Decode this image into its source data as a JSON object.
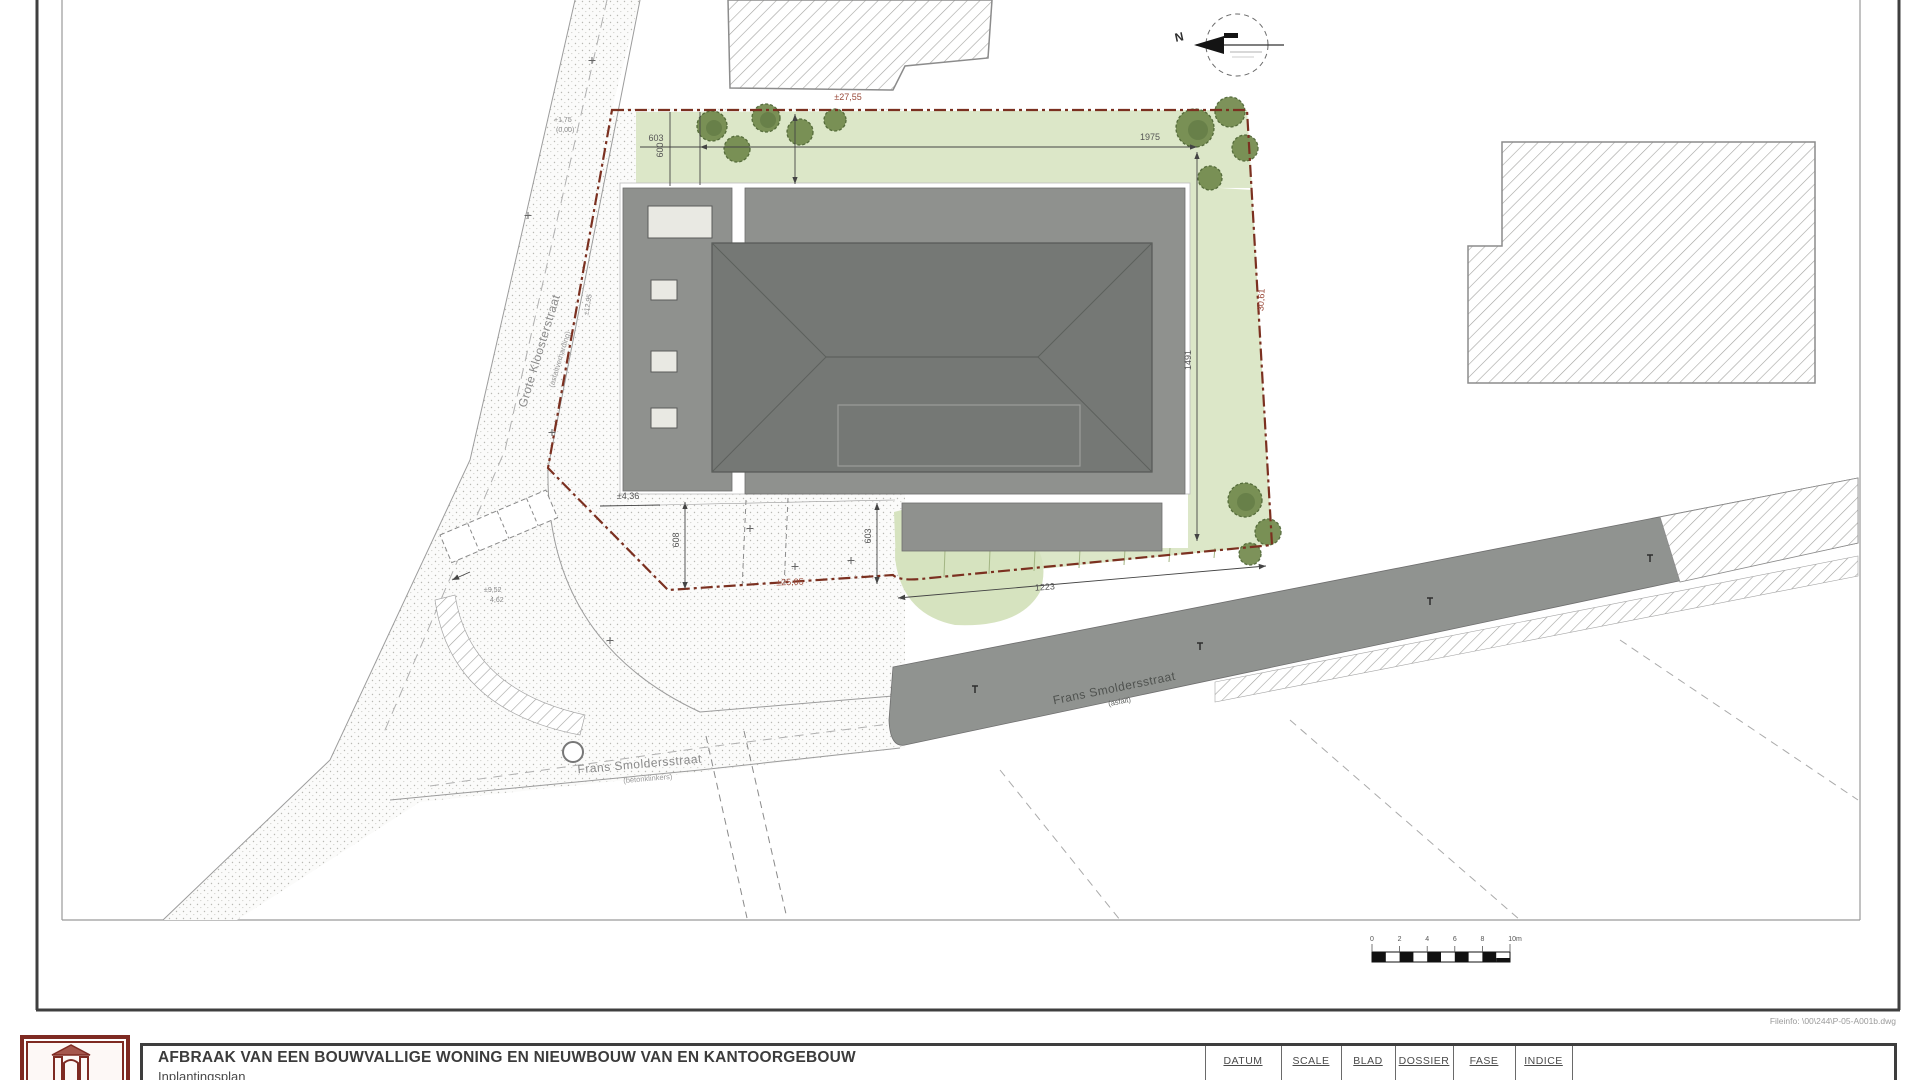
{
  "sheet": {
    "fileinfo": "Fileinfo: \\00\\244\\P-05-A001b.dwg"
  },
  "titleblock": {
    "title": "AFBRAAK VAN EEN BOUWVALLIGE WONING EN NIEUWBOUW VAN EN KANTOORGEBOUW",
    "subtitle": "Inplantingsplan",
    "headers": [
      "DATUM",
      "SCALE",
      "BLAD",
      "DOSSIER",
      "FASE",
      "INDICE"
    ]
  },
  "map": {
    "north_label": "N",
    "streets": {
      "grote": {
        "name": "Grote Kloosterstraat",
        "sub": "(asfaltverharding)"
      },
      "frans_west": {
        "name": "Frans Smoldersstraat",
        "sub": "(betonklinkers)"
      },
      "frans_road": {
        "name": "Frans Smoldersstraat",
        "sub": "(asfalt)"
      }
    },
    "dims": {
      "d2755": "±27,55",
      "d1975": "1975",
      "d603": "603",
      "d600": "600",
      "d1491": "1491",
      "d3061": "30,61",
      "d1295": "±12,95",
      "d2505": "±25,05",
      "d1223": "1223",
      "d436": "±4,36",
      "d608": "608",
      "d603b": "603",
      "d952": "±9,52",
      "d462": "4,62",
      "lvl_a": "+1,75",
      "lvl_b": "(0,00)"
    },
    "scalebar": {
      "labels": [
        "0",
        "2",
        "4",
        "6",
        "8",
        "10m"
      ]
    },
    "colors": {
      "boundary": "#7b3020",
      "lawn": "#dce7c8",
      "roof_dark": "#757875",
      "building_gray": "#8f918e",
      "road": "#909390",
      "logo": "#7e2a22"
    }
  }
}
